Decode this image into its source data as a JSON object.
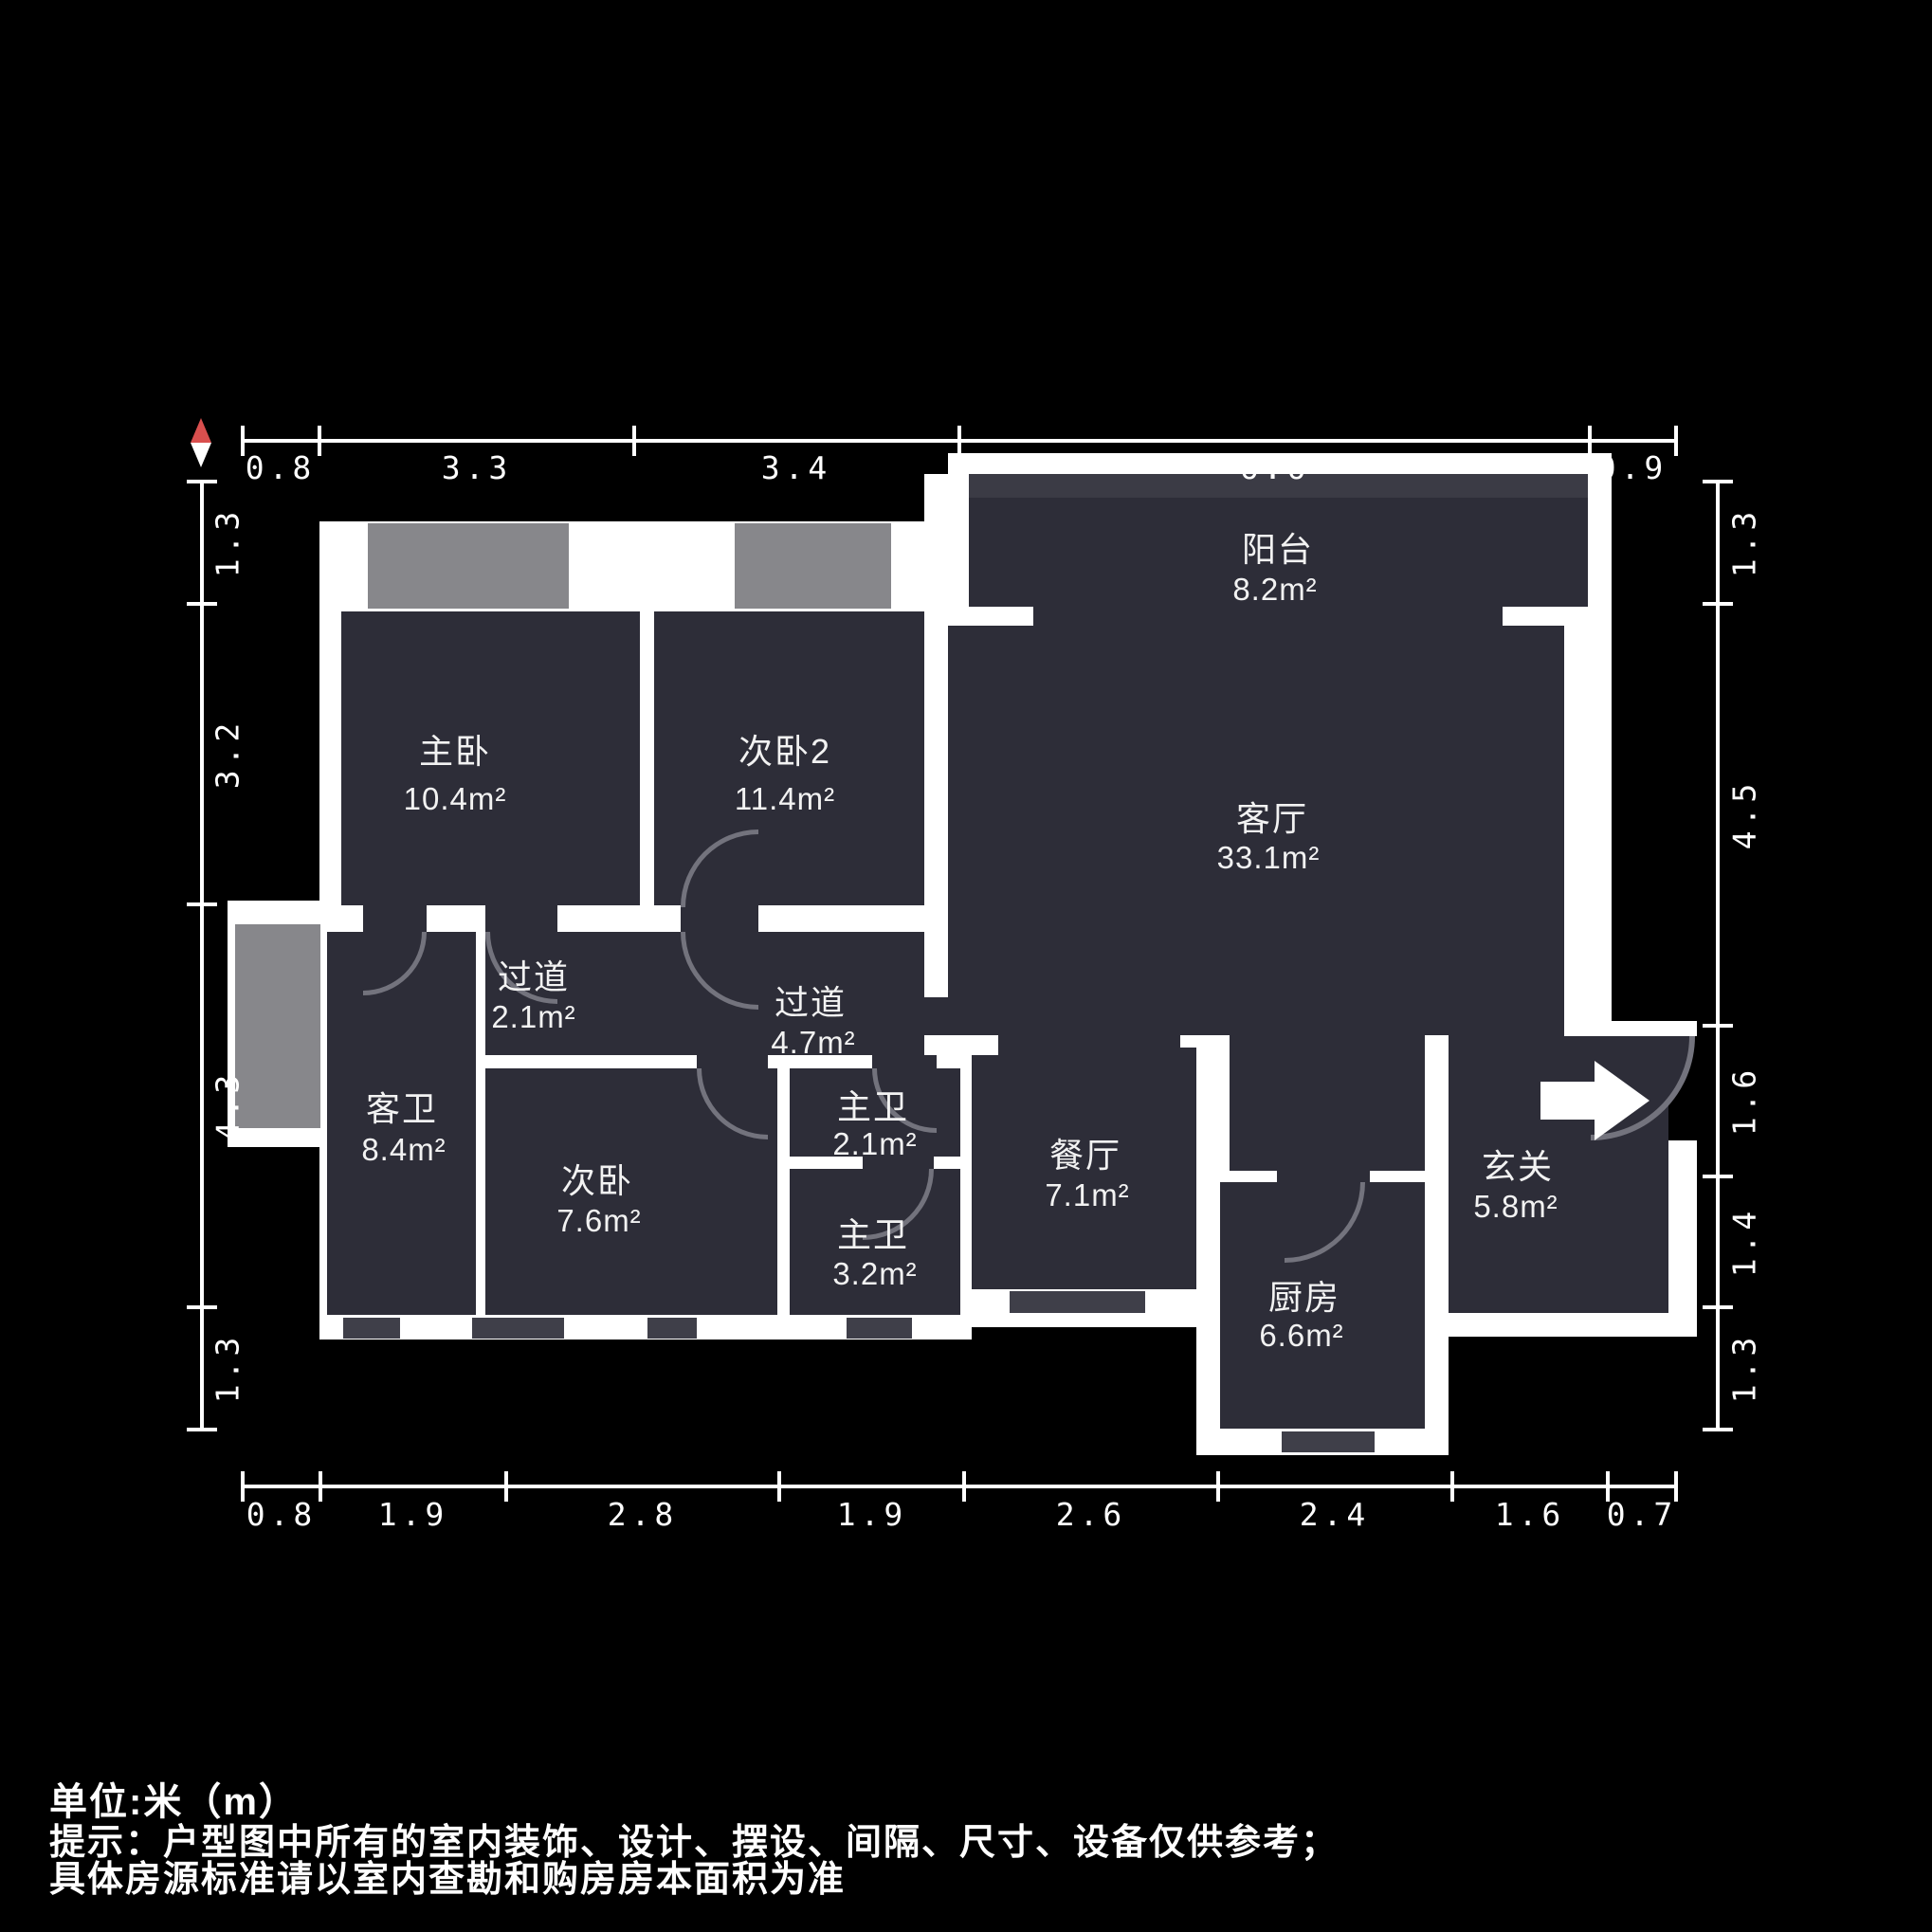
{
  "title": "户型图",
  "compass": {
    "icon": "north-compass-icon",
    "red": "#d94f4e"
  },
  "rooms": [
    {
      "name": "阳台",
      "area": "8.2m²"
    },
    {
      "name": "主卧",
      "area": "10.4m²"
    },
    {
      "name": "次卧2",
      "area": "11.4m²"
    },
    {
      "name": "客厅",
      "area": "33.1m²"
    },
    {
      "name": "过道",
      "area": "2.1m²"
    },
    {
      "name": "过道",
      "area": "4.7m²"
    },
    {
      "name": "客卫",
      "area": "8.4m²"
    },
    {
      "name": "次卧",
      "area": "7.6m²"
    },
    {
      "name": "主卫",
      "area": "2.1m²"
    },
    {
      "name": "主卫",
      "area": "3.2m²"
    },
    {
      "name": "餐厅",
      "area": "7.1m²"
    },
    {
      "name": "厨房",
      "area": "6.6m²"
    },
    {
      "name": "玄关",
      "area": "5.8m²"
    }
  ],
  "rulers": {
    "top": [
      "0.8",
      "3.3",
      "3.4",
      "6.6",
      "0.9"
    ],
    "bottom": [
      "0.8",
      "1.9",
      "2.8",
      "1.9",
      "2.6",
      "2.4",
      "1.6",
      "0.7"
    ],
    "left": [
      "1.3",
      "3.2",
      "4.3",
      "1.3"
    ],
    "right": [
      "1.3",
      "4.5",
      "1.6",
      "1.4",
      "1.3"
    ]
  },
  "footer": {
    "line1": "单位:米（m）",
    "line2": "提示：户型图中所有的室内装饰、设计、摆设、间隔、尺寸、设备仅供参考；",
    "line3": "具体房源标准请以室内查勘和购房房本面积为准"
  },
  "colors": {
    "room_fill": "#2d2d38",
    "wall": "#ffffff",
    "window": "#87878b",
    "window_sill": "#3f3f49",
    "balcony_band": "#3b3b45",
    "door_arc": "#73737d",
    "compass_red": "#d94f4e",
    "background": "#000000",
    "text": "#f2f2f2"
  }
}
